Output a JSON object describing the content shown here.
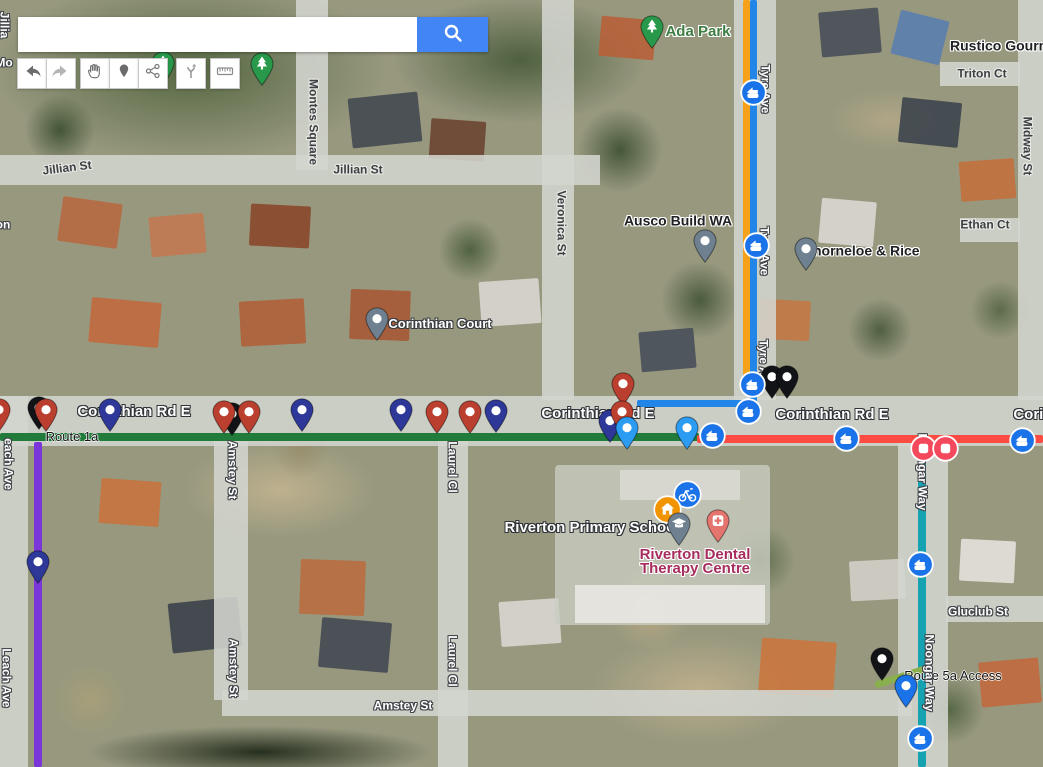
{
  "search": {
    "value": ""
  },
  "toolbar": {
    "buttons": [
      "back",
      "forward",
      "pan",
      "add-marker",
      "share",
      "directions-fork",
      "measure"
    ]
  },
  "colors": {
    "search_button": "#4285f4",
    "markers": {
      "red": "#bb3f2e",
      "navy": "#2d3899",
      "black": "#111317",
      "gray": "#6f8191",
      "green": "#28994b",
      "skyblue": "#2b9cf2",
      "blue": "#1a73e8",
      "coral": "#e4756e",
      "bus": "#1a73e8",
      "station": "#f4485c",
      "home": "#f29300",
      "bike": "#1a73e8"
    }
  },
  "map": {
    "routes": [
      {
        "name": "route-orange-tyre-ave",
        "color": "#f7a11a",
        "x": 743,
        "y": 0,
        "w": 7,
        "h": 390,
        "rot": 0
      },
      {
        "name": "route-blue-tyre-ave",
        "color": "#2186e8",
        "x": 750,
        "y": 0,
        "w": 7,
        "h": 412,
        "rot": 0
      },
      {
        "name": "route-blue-corinthian",
        "color": "#2186e8",
        "x": 637,
        "y": 400,
        "w": 120,
        "h": 7,
        "rot": 0
      },
      {
        "name": "route-1a-green",
        "color": "#217c3b",
        "x": 0,
        "y": 433,
        "w": 699,
        "h": 8,
        "rot": 0
      },
      {
        "name": "route-red-corinthian",
        "color": "#fb4b43",
        "x": 697,
        "y": 435,
        "w": 346,
        "h": 8,
        "rot": 0
      },
      {
        "name": "route-purple-leach-ave",
        "color": "#7a36d9",
        "x": 34,
        "y": 442,
        "w": 8,
        "h": 325,
        "rot": 0
      },
      {
        "name": "route-teal-noongar-way",
        "color": "#17a2b2",
        "x": 918,
        "y": 445,
        "w": 8,
        "h": 322,
        "rot": 0
      },
      {
        "name": "route-5a-access",
        "color": "#8ab04e",
        "x": 874,
        "y": 673,
        "w": 56,
        "h": 7,
        "rot": -18
      }
    ],
    "labels": [
      {
        "text": "Jillian St",
        "x": 67,
        "y": 168,
        "rot": -7,
        "style": "road-dark",
        "name": "street-label-jillian-st"
      },
      {
        "text": "Jillian St",
        "x": 358,
        "y": 170,
        "rot": 0,
        "style": "road-dark",
        "name": "street-label-jillian-st"
      },
      {
        "text": "Montes Square",
        "x": 313,
        "y": 122,
        "rot": 90,
        "style": "road-dark",
        "name": "street-label-montes-square"
      },
      {
        "text": "Veronica St",
        "x": 561,
        "y": 223,
        "rot": 90,
        "style": "road-dark",
        "name": "street-label-veronica-st"
      },
      {
        "text": "Tyre Ave",
        "x": 765,
        "y": 89,
        "rot": 90,
        "style": "road-white",
        "name": "street-label-tyre-ave"
      },
      {
        "text": "Tyre Ave",
        "x": 764,
        "y": 251,
        "rot": 90,
        "style": "road-white",
        "name": "street-label-tyre-ave"
      },
      {
        "text": "Tyre Ave",
        "x": 763,
        "y": 364,
        "rot": 90,
        "style": "road-white",
        "name": "street-label-tyre-ave"
      },
      {
        "text": "Midway St",
        "x": 1027,
        "y": 146,
        "rot": 90,
        "style": "road-dark",
        "name": "street-label-midway-st"
      },
      {
        "text": "Triton Ct",
        "x": 982,
        "y": 74,
        "rot": 0,
        "style": "road-dark",
        "name": "street-label-triton-ct"
      },
      {
        "text": "Ethan Ct",
        "x": 985,
        "y": 225,
        "rot": 0,
        "style": "road-dark",
        "name": "street-label-ethan-ct"
      },
      {
        "text": "Rustico Gourm",
        "x": 950,
        "y": 46,
        "rot": 0,
        "style": "poi-dark",
        "name": "poi-label-rustico-gourmet",
        "anchor": "left"
      },
      {
        "text": "Ada Park",
        "x": 698,
        "y": 32,
        "rot": 0,
        "style": "park-green",
        "name": "poi-label-ada-park"
      },
      {
        "text": "Ausco Build WA",
        "x": 678,
        "y": 221,
        "rot": 0,
        "style": "poi-dark",
        "name": "poi-label-ausco-build-wa"
      },
      {
        "text": "Thorneloe & Rice",
        "x": 862,
        "y": 251,
        "rot": 0,
        "style": "poi-dark",
        "name": "poi-label-thorneloe-rice"
      },
      {
        "text": "Corinthian Court",
        "x": 440,
        "y": 324,
        "rot": 0,
        "style": "poi-white",
        "name": "poi-label-corinthian-court"
      },
      {
        "text": "Corinthian Rd E",
        "x": 134,
        "y": 412,
        "rot": 0,
        "style": "road-white-lg",
        "name": "street-label-corinthian-rd-e"
      },
      {
        "text": "Corinthian Rd E",
        "x": 598,
        "y": 414,
        "rot": 0,
        "style": "road-white-lg",
        "name": "street-label-corinthian-rd-e"
      },
      {
        "text": "Corinthian Rd E",
        "x": 832,
        "y": 415,
        "rot": 0,
        "style": "road-white-lg",
        "name": "street-label-corinthian-rd-e"
      },
      {
        "text": "Corinthian Rd E",
        "x": 1070,
        "y": 415,
        "rot": 0,
        "style": "road-white-lg",
        "name": "street-label-corinthian-rd-e"
      },
      {
        "text": "Route 1a",
        "x": 72,
        "y": 437,
        "rot": 0,
        "style": "route-black",
        "name": "route-label-route-1a"
      },
      {
        "text": "Route 5a Access",
        "x": 953,
        "y": 676,
        "rot": 0,
        "style": "route-black",
        "name": "route-label-route-5a-access"
      },
      {
        "text": "each Ave",
        "x": 8,
        "y": 464,
        "rot": 90,
        "style": "road-white",
        "name": "street-label-leach-ave"
      },
      {
        "text": "Leach Ave",
        "x": 6,
        "y": 678,
        "rot": 90,
        "style": "road-white",
        "name": "street-label-leach-ave"
      },
      {
        "text": "Amstey St",
        "x": 232,
        "y": 470,
        "rot": 90,
        "style": "road-white",
        "name": "street-label-amstey-st"
      },
      {
        "text": "Amstey St",
        "x": 233,
        "y": 668,
        "rot": 90,
        "style": "road-white",
        "name": "street-label-amstey-st"
      },
      {
        "text": "Amstey St",
        "x": 403,
        "y": 706,
        "rot": 0,
        "style": "road-white",
        "name": "street-label-amstey-st"
      },
      {
        "text": "Laurel Cl",
        "x": 452,
        "y": 467,
        "rot": 90,
        "style": "road-white",
        "name": "street-label-laurel-cl"
      },
      {
        "text": "Laurel Cl",
        "x": 452,
        "y": 661,
        "rot": 90,
        "style": "road-white",
        "name": "street-label-laurel-cl"
      },
      {
        "text": "Gluclub St",
        "x": 978,
        "y": 612,
        "rot": 0,
        "style": "road-white",
        "name": "street-label-gluclub-st"
      },
      {
        "text": "Noongar Way",
        "x": 922,
        "y": 472,
        "rot": 90,
        "style": "road-white",
        "name": "street-label-noongar-way"
      },
      {
        "text": "Noongar Way",
        "x": 929,
        "y": 673,
        "rot": 90,
        "style": "road-white",
        "name": "street-label-noongar-way"
      },
      {
        "text": "Riverton Primary School",
        "x": 592,
        "y": 528,
        "rot": 0,
        "style": "poi-white-lg",
        "name": "poi-label-riverton-primary-school"
      },
      {
        "text": "Riverton Dental",
        "x": 695,
        "y": 555,
        "rot": 0,
        "style": "dental",
        "name": "poi-label-riverton-dental-1"
      },
      {
        "text": "Therapy Centre",
        "x": 695,
        "y": 569,
        "rot": 0,
        "style": "dental",
        "name": "poi-label-riverton-dental-2"
      },
      {
        "text": "Jillia",
        "x": 4,
        "y": 25,
        "rot": 90,
        "style": "road-white",
        "name": "street-label-jillian-cut"
      },
      {
        "text": "Mo",
        "x": 4,
        "y": 63,
        "rot": 0,
        "style": "road-white",
        "name": "street-label-cut-mo"
      },
      {
        "text": "on",
        "x": 3,
        "y": 225,
        "rot": 0,
        "style": "road-white",
        "name": "street-label-cut-on"
      }
    ],
    "markers": [
      {
        "kind": "pin",
        "color": "green",
        "glyph": "tree",
        "x": 163,
        "y": 84,
        "name": "park-pin"
      },
      {
        "kind": "pin",
        "color": "green",
        "glyph": "tree",
        "x": 262,
        "y": 85,
        "name": "park-pin"
      },
      {
        "kind": "pin",
        "color": "green",
        "glyph": "tree",
        "x": 652,
        "y": 48,
        "name": "ada-park-pin"
      },
      {
        "kind": "pin",
        "color": "gray",
        "glyph": "dot",
        "x": 705,
        "y": 262,
        "name": "ausco-build-wa-pin"
      },
      {
        "kind": "pin",
        "color": "gray",
        "glyph": "dot",
        "x": 806,
        "y": 270,
        "name": "thorneloe-rice-pin"
      },
      {
        "kind": "pin",
        "color": "gray",
        "glyph": "dot",
        "x": 377,
        "y": 340,
        "name": "corinthian-court-pin"
      },
      {
        "kind": "pin",
        "color": "red",
        "glyph": "dot",
        "x": -1,
        "y": 431,
        "name": "stop-pin-red"
      },
      {
        "kind": "pin",
        "color": "black",
        "glyph": "dot",
        "x": 39,
        "y": 429,
        "name": "stop-pin-black"
      },
      {
        "kind": "pin",
        "color": "red",
        "glyph": "dot",
        "x": 46,
        "y": 431,
        "name": "stop-pin-red"
      },
      {
        "kind": "pin",
        "color": "navy",
        "glyph": "dot",
        "x": 110,
        "y": 431,
        "name": "stop-pin-navy"
      },
      {
        "kind": "pin",
        "color": "black",
        "glyph": "dot",
        "x": 232,
        "y": 435,
        "name": "stop-pin-black"
      },
      {
        "kind": "pin",
        "color": "red",
        "glyph": "dot",
        "x": 224,
        "y": 433,
        "name": "stop-pin-red"
      },
      {
        "kind": "pin",
        "color": "red",
        "glyph": "dot",
        "x": 249,
        "y": 433,
        "name": "stop-pin-red"
      },
      {
        "kind": "pin",
        "color": "navy",
        "glyph": "dot",
        "x": 302,
        "y": 431,
        "name": "stop-pin-navy"
      },
      {
        "kind": "pin",
        "color": "navy",
        "glyph": "dot",
        "x": 401,
        "y": 431,
        "name": "stop-pin-navy"
      },
      {
        "kind": "pin",
        "color": "red",
        "glyph": "dot",
        "x": 437,
        "y": 433,
        "name": "stop-pin-red"
      },
      {
        "kind": "pin",
        "color": "red",
        "glyph": "dot",
        "x": 470,
        "y": 433,
        "name": "stop-pin-red"
      },
      {
        "kind": "pin",
        "color": "navy",
        "glyph": "dot",
        "x": 496,
        "y": 432,
        "name": "stop-pin-navy"
      },
      {
        "kind": "pin",
        "color": "navy",
        "glyph": "dot",
        "x": 610,
        "y": 442,
        "name": "stop-pin-navy"
      },
      {
        "kind": "pin",
        "color": "red",
        "glyph": "dot",
        "x": 623,
        "y": 405,
        "name": "stop-pin-red"
      },
      {
        "kind": "pin",
        "color": "red",
        "glyph": "dot",
        "x": 622,
        "y": 433,
        "name": "stop-pin-red"
      },
      {
        "kind": "pin",
        "color": "skyblue",
        "glyph": "dot",
        "x": 627,
        "y": 449,
        "name": "stop-pin-skyblue"
      },
      {
        "kind": "pin",
        "color": "skyblue",
        "glyph": "dot",
        "x": 687,
        "y": 449,
        "name": "stop-pin-skyblue"
      },
      {
        "kind": "pin",
        "color": "black",
        "glyph": "dot",
        "x": 772,
        "y": 398,
        "name": "stop-pin-black"
      },
      {
        "kind": "pin",
        "color": "black",
        "glyph": "dot",
        "x": 787,
        "y": 398,
        "name": "stop-pin-black"
      },
      {
        "kind": "pin",
        "color": "navy",
        "glyph": "dot",
        "x": 38,
        "y": 583,
        "name": "stop-pin-navy"
      },
      {
        "kind": "bike",
        "x": 687,
        "y": 494,
        "name": "cycling-poi-icon"
      },
      {
        "kind": "home",
        "x": 667,
        "y": 509,
        "name": "home-poi-icon"
      },
      {
        "kind": "pin",
        "color": "gray",
        "glyph": "cap",
        "x": 679,
        "y": 545,
        "name": "school-pin"
      },
      {
        "kind": "pin",
        "color": "coral",
        "glyph": "cross",
        "x": 718,
        "y": 542,
        "name": "dental-pin"
      },
      {
        "kind": "pin",
        "color": "black",
        "glyph": "dot",
        "x": 882,
        "y": 680,
        "name": "stop-pin-black"
      },
      {
        "kind": "pin",
        "color": "blue",
        "glyph": "dot",
        "x": 906,
        "y": 707,
        "name": "stop-pin-blue"
      },
      {
        "kind": "bus",
        "x": 753,
        "y": 92,
        "name": "bus-stop-icon"
      },
      {
        "kind": "bus",
        "x": 756,
        "y": 245,
        "name": "bus-stop-icon"
      },
      {
        "kind": "bus",
        "x": 752,
        "y": 384,
        "name": "bus-stop-icon"
      },
      {
        "kind": "bus",
        "x": 748,
        "y": 411,
        "name": "bus-stop-icon"
      },
      {
        "kind": "bus",
        "x": 712,
        "y": 435,
        "name": "bus-stop-icon"
      },
      {
        "kind": "bus",
        "x": 846,
        "y": 438,
        "name": "bus-stop-icon"
      },
      {
        "kind": "bus",
        "x": 1022,
        "y": 440,
        "name": "bus-stop-icon"
      },
      {
        "kind": "bus",
        "x": 920,
        "y": 564,
        "name": "bus-stop-icon"
      },
      {
        "kind": "bus",
        "x": 920,
        "y": 738,
        "name": "bus-stop-icon"
      },
      {
        "kind": "station",
        "x": 923,
        "y": 448,
        "name": "station-stop-icon"
      },
      {
        "kind": "station",
        "x": 945,
        "y": 448,
        "name": "station-stop-icon"
      }
    ]
  }
}
